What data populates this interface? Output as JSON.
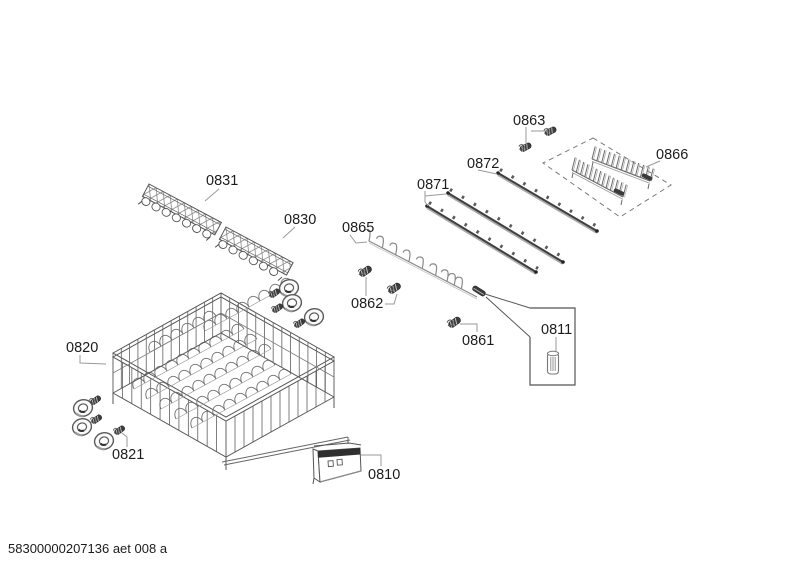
{
  "footer": "58300000207136 aet 008 a",
  "labels": {
    "p0810": "0810",
    "p0811": "0811",
    "p0820": "0820",
    "p0821": "0821",
    "p0830": "0830",
    "p0831": "0831",
    "p0861": "0861",
    "p0862": "0862",
    "p0863": "0863",
    "p0865": "0865",
    "p0866": "0866",
    "p0871": "0871",
    "p0872": "0872"
  }
}
